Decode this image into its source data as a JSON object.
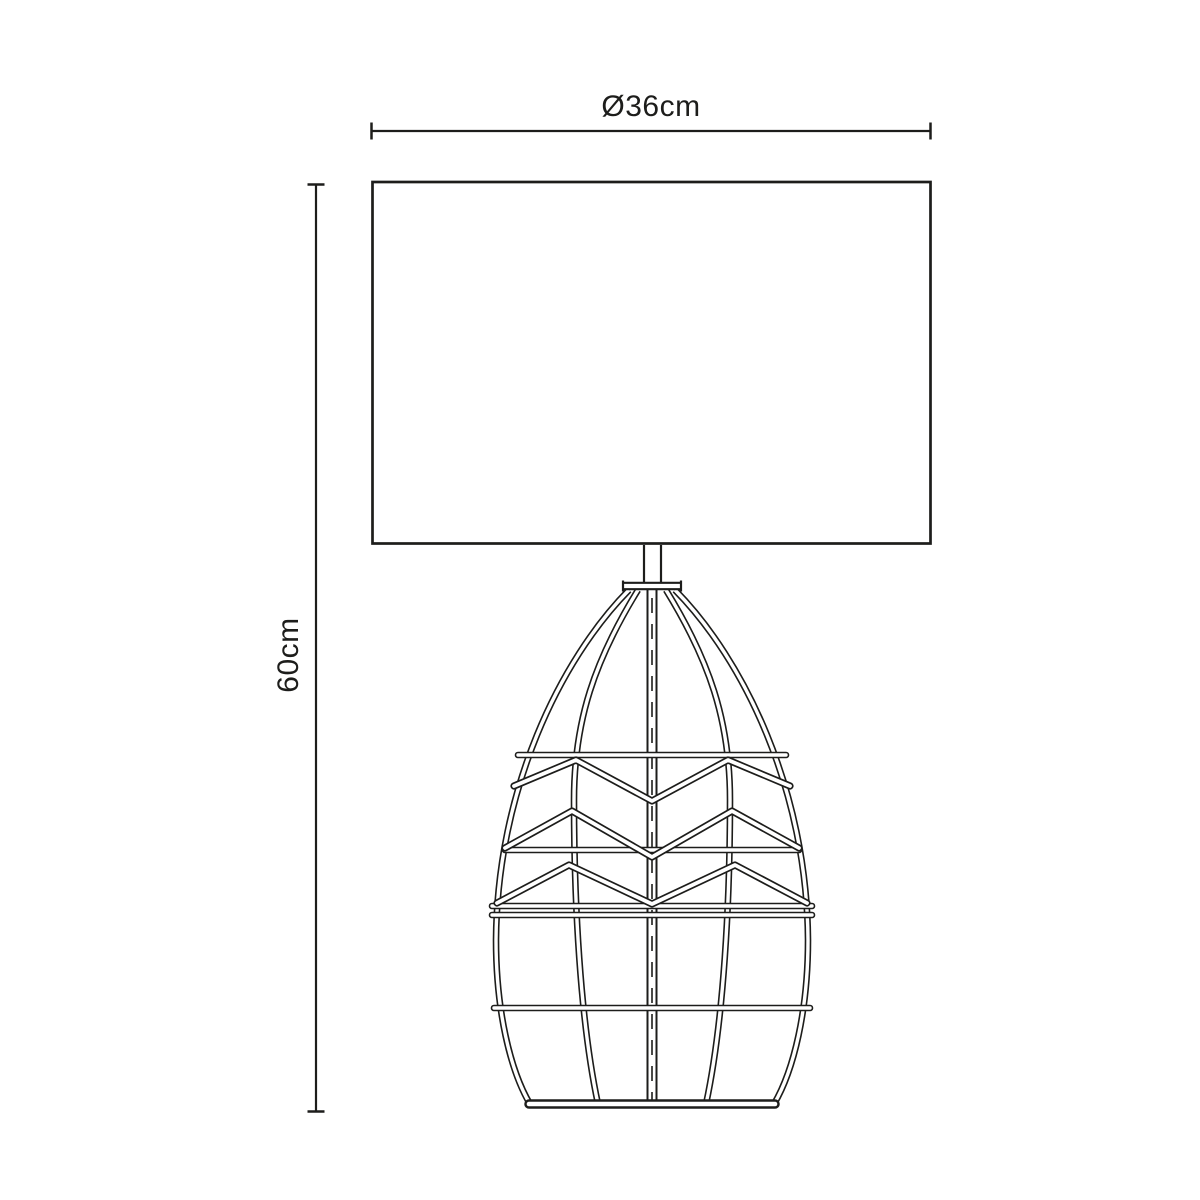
{
  "diagram": {
    "width_dimension": {
      "label": "Ø36cm"
    },
    "height_dimension": {
      "label": "60cm"
    },
    "colors": {
      "line": "#1d1d1b",
      "background": "#ffffff"
    }
  }
}
